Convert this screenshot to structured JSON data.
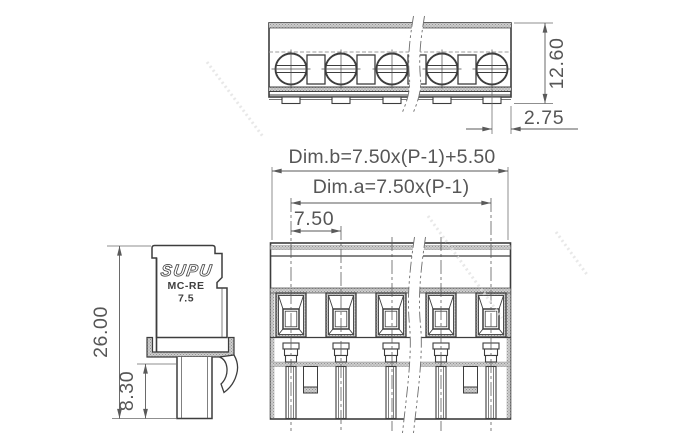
{
  "product": {
    "brand": "SUPU",
    "series": "MC-RE",
    "pitch_label": "7.5"
  },
  "dimensions": {
    "top_view_height": "12.60",
    "end_margin": "2.75",
    "dim_b_formula": "Dim.b=7.50x(P-1)+5.50",
    "dim_a_formula": "Dim.a=7.50x(P-1)",
    "pitch": "7.50",
    "overall_height": "26.00",
    "pin_section_height": "8.30"
  },
  "colors": {
    "line": "#3d3d3d",
    "dimension": "#5a5a5a",
    "hatch_fill": "#cdcdcd",
    "background": "#ffffff"
  }
}
